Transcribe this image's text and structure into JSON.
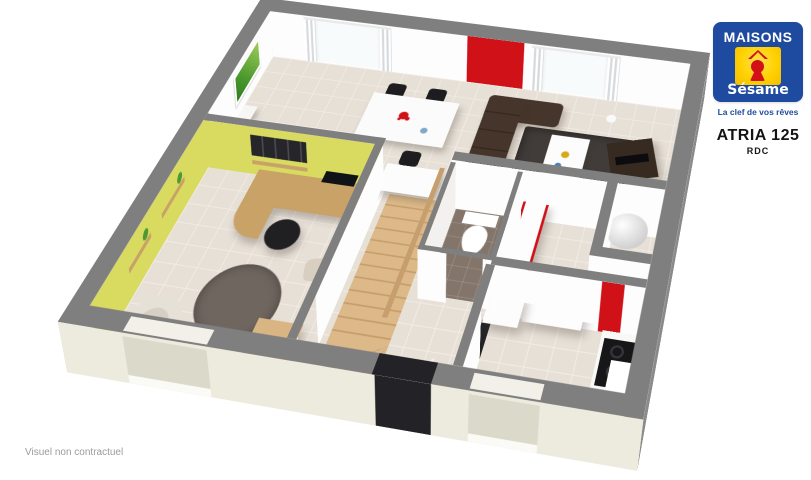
{
  "branding": {
    "logo_top": "MAISONS",
    "logo_bottom": "Sésame",
    "tagline": "La clef de vos rêves"
  },
  "plan_info": {
    "model": "ATRIA 125",
    "level": "RDC"
  },
  "footer": {
    "disclaimer": "Visuel non contractuel"
  },
  "icons": [
    {
      "name": "roof-icon"
    },
    {
      "name": "keyhole-icon"
    }
  ],
  "colors": {
    "logo_blue": "#1e4b9f",
    "logo_yellow": "#ffd102",
    "brand_red": "#d21016",
    "wall_gray": "#7f7f7f",
    "wall_gray_outer": "#8a8a8a",
    "accent_red": "#d01117",
    "office_yellow": "#d9db60",
    "floor_tile": "#e7e0d7",
    "grout": "#f3ede6",
    "wood_light": "#d9b584",
    "wood_medium": "#c9a267",
    "sofa_brown": "#46352a",
    "rug_dark": "#413c39",
    "rug_office": "#6f665f",
    "wc_floor": "#83756a",
    "cream_base": "#ecebdd",
    "door_dark": "#232327"
  }
}
